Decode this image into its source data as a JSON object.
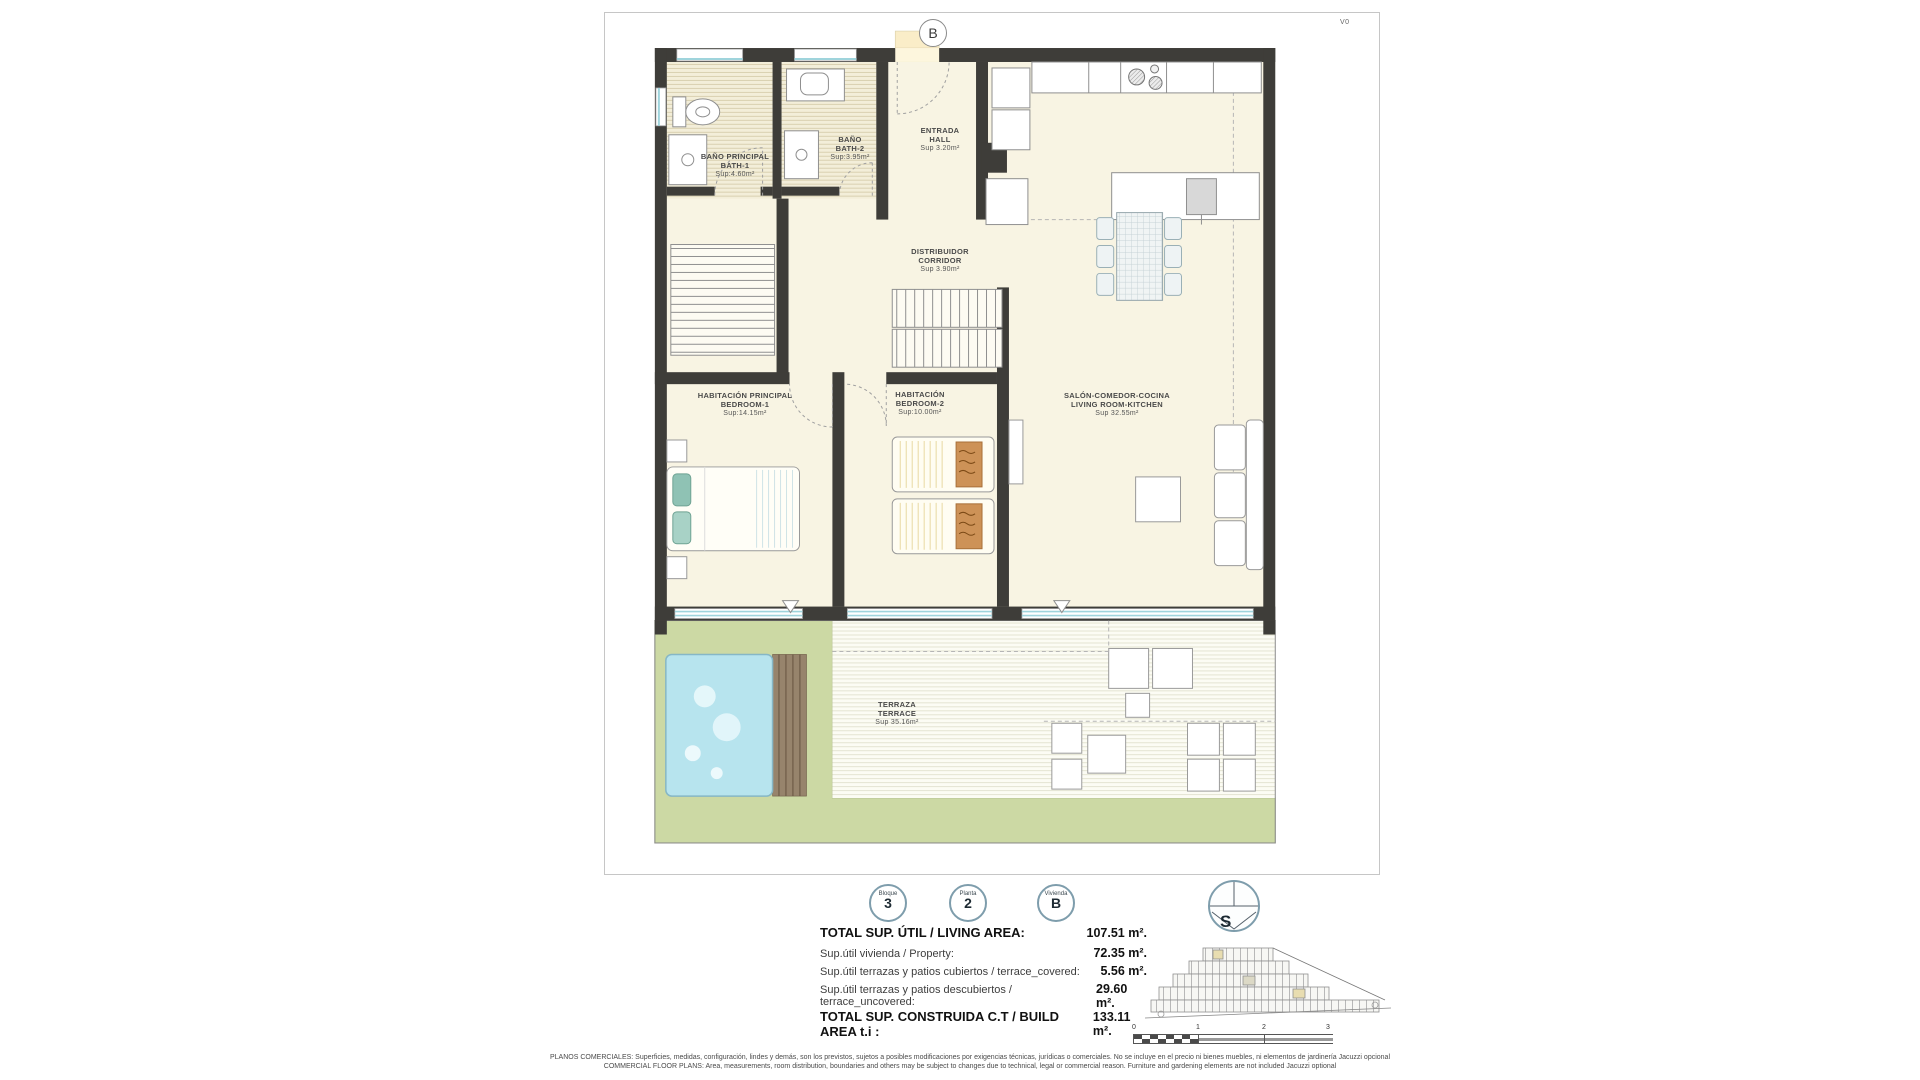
{
  "sheet": {
    "marker": "B",
    "version": "V0"
  },
  "rooms": {
    "bath1": {
      "line1": "BAÑO PRINCIPAL",
      "line2": "BATH-1",
      "area": "Sup:4.60m²"
    },
    "bath2": {
      "line1": "BAÑO",
      "line2": "BATH-2",
      "area": "Sup:3.95m²"
    },
    "hall": {
      "line1": "ENTRADA",
      "line2": "HALL",
      "area": "Sup 3.20m²"
    },
    "corridor": {
      "line1": "DISTRIBUIDOR",
      "line2": "CORRIDOR",
      "area": "Sup 3.90m²"
    },
    "bedroom1": {
      "line1": "HABITACIÓN PRINCIPAL",
      "line2": "BEDROOM-1",
      "area": "Sup:14.15m²"
    },
    "bedroom2": {
      "line1": "HABITACIÓN",
      "line2": "BEDROOM-2",
      "area": "Sup:10.00m²"
    },
    "living": {
      "line1": "SALÓN-COMEDOR-COCINA",
      "line2": "LIVING ROOM-KITCHEN",
      "area": "Sup 32.55m²"
    },
    "terrace": {
      "line1": "TERRAZA",
      "line2": "TERRACE",
      "area": "Sup 35.16m²"
    }
  },
  "badges": [
    {
      "label": "Bloque",
      "value": "3"
    },
    {
      "label": "Planta",
      "value": "2"
    },
    {
      "label": "Vivienda",
      "value": "B"
    }
  ],
  "compass": {
    "letter": "S"
  },
  "summary": {
    "rows": [
      {
        "label": "TOTAL SUP. ÚTIL / LIVING AREA:",
        "value": "107.51 m²."
      },
      {
        "label": "Sup.útil vivienda / Property:",
        "value": "72.35 m²."
      },
      {
        "label": "Sup.útil terrazas y patios cubiertos / terrace_covered:",
        "value": "5.56 m²."
      },
      {
        "label": "Sup.útil terrazas y patios descubiertos / terrace_uncovered:",
        "value": "29.60 m²."
      },
      {
        "label": "TOTAL SUP. CONSTRUIDA C.T / BUILD AREA t.i :",
        "value": "133.11 m²."
      }
    ]
  },
  "scalebar": {
    "ticks": [
      "0",
      "1",
      "2",
      "3"
    ]
  },
  "disclaimer": {
    "line1": "PLANOS COMERCIALES: Superficies, medidas, configuración, lindes y demás, son los previstos, sujetos a posibles modificaciones por exigencias técnicas, jurídicas o comerciales. No se incluye en el precio ni bienes muebles, ni elementos de jardinería Jacuzzi opcional",
    "line2": "COMMERCIAL FLOOR PLANS: Area, measurements, room distribution, boundaries and others may be subject to changes due to technical, legal or commercial reason. Furniture and gardening elements are not included Jacuzzi optional"
  },
  "colors": {
    "wall": "#3e3d39",
    "floor_cream": "#f8f4e3",
    "bath_hatch": "#d9d0b0",
    "lawn_green": "#ccd9a4",
    "pool_blue": "#b7e4ee",
    "window_cyan": "#9fd4dc",
    "badge_ring": "#7e9dac",
    "deck_brown": "#97846c",
    "throw_orange": "#cd9257"
  }
}
